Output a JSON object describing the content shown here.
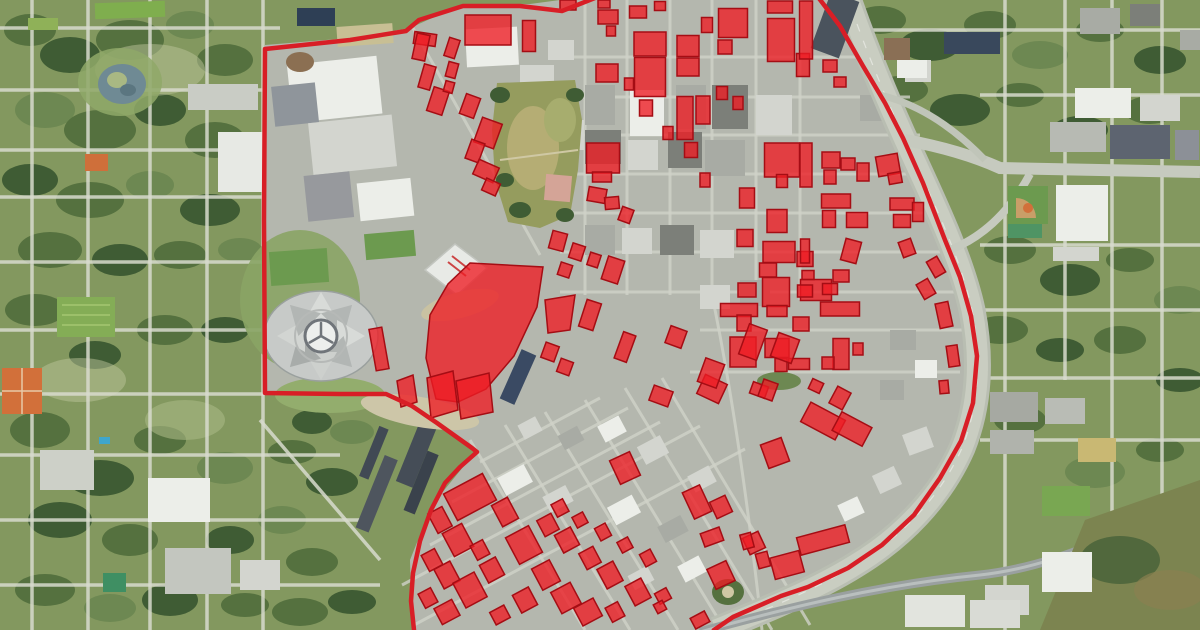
{
  "map": {
    "type": "aerial-satellite-with-overlay",
    "overlay": {
      "boundary_color": "#d81e26",
      "boundary_stroke_width": 4.5,
      "parcel_fill": "#ee1c24",
      "parcel_fill_opacity": 0.78,
      "parcel_stroke": "#a50d14",
      "parcel_stroke_width": 1.5,
      "boundary_points": [
        [
          600,
          -4
        ],
        [
          562,
          11
        ],
        [
          520,
          6
        ],
        [
          463,
          6
        ],
        [
          419,
          20
        ],
        [
          406,
          31
        ],
        [
          350,
          40
        ],
        [
          265,
          49
        ],
        [
          264,
          220
        ],
        [
          265,
          393
        ],
        [
          340,
          394
        ],
        [
          386,
          394
        ],
        [
          412,
          406
        ],
        [
          437,
          423
        ],
        [
          458,
          438
        ],
        [
          472,
          448
        ],
        [
          477,
          452
        ],
        [
          460,
          467
        ],
        [
          445,
          483
        ],
        [
          431,
          510
        ],
        [
          420,
          541
        ],
        [
          413,
          573
        ],
        [
          411,
          601
        ],
        [
          414,
          630
        ],
        [
          416,
          655
        ],
        [
          698,
          655
        ],
        [
          714,
          630
        ],
        [
          733,
          617
        ],
        [
          756,
          607
        ],
        [
          781,
          596
        ],
        [
          808,
          587
        ],
        [
          848,
          568
        ],
        [
          882,
          545
        ],
        [
          914,
          515
        ],
        [
          940,
          478
        ],
        [
          961,
          441
        ],
        [
          973,
          403
        ],
        [
          977,
          356
        ],
        [
          971,
          316
        ],
        [
          960,
          277
        ],
        [
          945,
          240
        ],
        [
          923,
          183
        ],
        [
          903,
          138
        ],
        [
          885,
          103
        ],
        [
          863,
          66
        ],
        [
          840,
          26
        ],
        [
          818,
          -3
        ],
        [
          790,
          -30
        ],
        [
          650,
          -30
        ]
      ],
      "parcel_rects": [
        [
          488,
          30,
          46,
          30,
          0
        ],
        [
          529,
          36,
          13,
          31,
          0
        ],
        [
          425,
          39,
          22,
          12,
          8
        ],
        [
          452,
          48,
          11,
          19,
          18
        ],
        [
          421,
          47,
          13,
          26,
          12
        ],
        [
          427,
          77,
          12,
          24,
          16
        ],
        [
          452,
          70,
          10,
          15,
          15
        ],
        [
          438,
          101,
          16,
          25,
          18
        ],
        [
          470,
          106,
          15,
          21,
          20
        ],
        [
          449,
          87,
          9,
          11,
          15
        ],
        [
          488,
          133,
          21,
          26,
          20
        ],
        [
          475,
          151,
          14,
          20,
          20
        ],
        [
          486,
          171,
          22,
          16,
          24
        ],
        [
          491,
          187,
          15,
          13,
          24
        ],
        [
          568,
          5,
          16,
          10,
          0
        ],
        [
          604,
          4,
          12,
          8,
          0
        ],
        [
          608,
          17,
          20,
          14,
          0
        ],
        [
          611,
          31,
          9,
          10,
          0
        ],
        [
          638,
          12,
          17,
          12,
          0
        ],
        [
          660,
          6,
          11,
          9,
          0
        ],
        [
          607,
          73,
          22,
          18,
          0
        ],
        [
          650,
          44,
          32,
          24,
          0
        ],
        [
          650,
          77,
          31,
          39,
          0
        ],
        [
          688,
          46,
          22,
          21,
          0
        ],
        [
          688,
          67,
          22,
          18,
          0
        ],
        [
          707,
          25,
          11,
          15,
          0
        ],
        [
          733,
          23,
          29,
          29,
          0
        ],
        [
          780,
          7,
          25,
          12,
          0
        ],
        [
          725,
          47,
          14,
          14,
          0
        ],
        [
          781,
          40,
          27,
          43,
          0
        ],
        [
          803,
          65,
          13,
          23,
          0
        ],
        [
          629,
          84,
          9,
          12,
          0
        ],
        [
          646,
          108,
          13,
          16,
          0
        ],
        [
          668,
          133,
          10,
          13,
          0
        ],
        [
          722,
          93,
          11,
          13,
          0
        ],
        [
          738,
          103,
          10,
          13,
          0
        ],
        [
          685,
          118,
          16,
          43,
          0
        ],
        [
          703,
          110,
          14,
          28,
          0
        ],
        [
          603,
          158,
          33,
          30,
          0
        ],
        [
          602,
          177,
          19,
          10,
          0
        ],
        [
          691,
          150,
          13,
          15,
          0
        ],
        [
          705,
          180,
          10,
          14,
          0
        ],
        [
          597,
          195,
          18,
          14,
          10
        ],
        [
          612,
          203,
          14,
          12,
          -5
        ],
        [
          626,
          215,
          12,
          14,
          20
        ],
        [
          782,
          160,
          35,
          34,
          0
        ],
        [
          782,
          181,
          11,
          13,
          0
        ],
        [
          747,
          198,
          15,
          20,
          0
        ],
        [
          777,
          221,
          20,
          23,
          0
        ],
        [
          745,
          238,
          16,
          17,
          0
        ],
        [
          779,
          252,
          32,
          21,
          0
        ],
        [
          768,
          270,
          17,
          14,
          0
        ],
        [
          805,
          259,
          16,
          15,
          0
        ],
        [
          830,
          66,
          14,
          12,
          0
        ],
        [
          840,
          82,
          12,
          10,
          0
        ],
        [
          806,
          30,
          13,
          58,
          0
        ],
        [
          806,
          165,
          12,
          44,
          0
        ],
        [
          831,
          160,
          18,
          16,
          0
        ],
        [
          848,
          164,
          14,
          12,
          0
        ],
        [
          863,
          172,
          12,
          18,
          0
        ],
        [
          830,
          177,
          12,
          14,
          0
        ],
        [
          888,
          165,
          22,
          20,
          -10
        ],
        [
          895,
          178,
          13,
          11,
          -10
        ],
        [
          836,
          201,
          29,
          14,
          0
        ],
        [
          829,
          219,
          13,
          17,
          0
        ],
        [
          857,
          220,
          21,
          15,
          0
        ],
        [
          902,
          204,
          24,
          12,
          0
        ],
        [
          902,
          221,
          17,
          13,
          0
        ],
        [
          918,
          212,
          11,
          19,
          0
        ],
        [
          851,
          251,
          16,
          22,
          15
        ],
        [
          805,
          251,
          9,
          24,
          0
        ],
        [
          816,
          290,
          31,
          21,
          0
        ],
        [
          907,
          248,
          13,
          16,
          -20
        ],
        [
          936,
          267,
          12,
          18,
          -30
        ],
        [
          926,
          289,
          13,
          17,
          -30
        ],
        [
          944,
          315,
          13,
          25,
          -12
        ],
        [
          953,
          356,
          11,
          21,
          -8
        ],
        [
          944,
          387,
          9,
          13,
          -5
        ],
        [
          747,
          290,
          18,
          14,
          0
        ],
        [
          776,
          292,
          27,
          29,
          0
        ],
        [
          805,
          291,
          15,
          12,
          0
        ],
        [
          808,
          275,
          12,
          9,
          0
        ],
        [
          841,
          276,
          16,
          12,
          0
        ],
        [
          830,
          289,
          15,
          11,
          0
        ],
        [
          739,
          310,
          37,
          13,
          0
        ],
        [
          744,
          323,
          14,
          16,
          0
        ],
        [
          777,
          311,
          20,
          11,
          0
        ],
        [
          840,
          309,
          39,
          14,
          0
        ],
        [
          801,
          324,
          16,
          14,
          0
        ],
        [
          743,
          352,
          26,
          30,
          0
        ],
        [
          777,
          348,
          24,
          19,
          0
        ],
        [
          781,
          365,
          12,
          13,
          0
        ],
        [
          799,
          364,
          21,
          11,
          0
        ],
        [
          841,
          354,
          16,
          31,
          0
        ],
        [
          828,
          363,
          12,
          12,
          0
        ],
        [
          858,
          349,
          10,
          12,
          0
        ],
        [
          712,
          389,
          24,
          21,
          25
        ],
        [
          816,
          386,
          12,
          11,
          25
        ],
        [
          840,
          398,
          15,
          19,
          28
        ],
        [
          823,
          421,
          39,
          22,
          28
        ],
        [
          852,
          429,
          34,
          21,
          28
        ],
        [
          759,
          390,
          16,
          12,
          20
        ],
        [
          558,
          241,
          15,
          18,
          15
        ],
        [
          577,
          252,
          13,
          15,
          18
        ],
        [
          594,
          260,
          11,
          13,
          18
        ],
        [
          565,
          270,
          12,
          13,
          18
        ],
        [
          613,
          270,
          17,
          24,
          18
        ],
        [
          590,
          315,
          15,
          28,
          18
        ],
        [
          625,
          347,
          13,
          28,
          20
        ],
        [
          676,
          337,
          17,
          18,
          20
        ],
        [
          550,
          352,
          14,
          16,
          20
        ],
        [
          565,
          367,
          13,
          14,
          20
        ],
        [
          661,
          396,
          20,
          16,
          20
        ],
        [
          711,
          373,
          20,
          25,
          20
        ],
        [
          753,
          342,
          19,
          32,
          20
        ],
        [
          768,
          390,
          15,
          18,
          20
        ],
        [
          785,
          348,
          22,
          25,
          20
        ],
        [
          625,
          468,
          22,
          26,
          -25
        ],
        [
          697,
          502,
          19,
          29,
          -25
        ],
        [
          721,
          507,
          17,
          18,
          -25
        ],
        [
          754,
          543,
          17,
          18,
          -25
        ],
        [
          721,
          575,
          21,
          22,
          -25
        ],
        [
          775,
          453,
          22,
          25,
          -20
        ],
        [
          379,
          349,
          13,
          42,
          -10
        ],
        [
          470,
          497,
          44,
          30,
          -28
        ],
        [
          440,
          520,
          16,
          22,
          -28
        ],
        [
          458,
          540,
          22,
          26,
          -28
        ],
        [
          432,
          560,
          15,
          18,
          -28
        ],
        [
          447,
          575,
          18,
          22,
          -28
        ],
        [
          428,
          598,
          14,
          16,
          -28
        ],
        [
          447,
          612,
          20,
          18,
          -28
        ],
        [
          470,
          590,
          24,
          28,
          -28
        ],
        [
          492,
          570,
          18,
          20,
          -28
        ],
        [
          480,
          550,
          14,
          16,
          -28
        ],
        [
          505,
          512,
          18,
          24,
          -28
        ],
        [
          524,
          545,
          26,
          30,
          -28
        ],
        [
          546,
          575,
          20,
          24,
          -28
        ],
        [
          566,
          598,
          22,
          24,
          -28
        ],
        [
          525,
          600,
          18,
          20,
          -28
        ],
        [
          500,
          615,
          16,
          14,
          -28
        ],
        [
          548,
          525,
          16,
          18,
          -28
        ],
        [
          567,
          540,
          18,
          20,
          -28
        ],
        [
          590,
          558,
          16,
          18,
          -28
        ],
        [
          610,
          575,
          18,
          22,
          -28
        ],
        [
          588,
          612,
          22,
          20,
          -28
        ],
        [
          615,
          612,
          14,
          16,
          -28
        ],
        [
          638,
          592,
          18,
          22,
          -28
        ],
        [
          663,
          596,
          13,
          12,
          -28
        ],
        [
          700,
          620,
          16,
          12,
          -28
        ],
        [
          560,
          508,
          13,
          14,
          -28
        ],
        [
          580,
          520,
          12,
          12,
          -28
        ],
        [
          603,
          532,
          12,
          14,
          -28
        ],
        [
          625,
          545,
          12,
          12,
          -28
        ],
        [
          648,
          558,
          12,
          14,
          -28
        ],
        [
          660,
          607,
          10,
          10,
          -28
        ],
        [
          712,
          537,
          20,
          14,
          -20
        ],
        [
          747,
          541,
          11,
          15,
          -15
        ],
        [
          763,
          560,
          12,
          15,
          -15
        ],
        [
          787,
          565,
          30,
          22,
          -15
        ],
        [
          823,
          540,
          50,
          18,
          -15
        ]
      ],
      "parcel_polygons": [
        [
          [
            470,
            263
          ],
          [
            543,
            267
          ],
          [
            537,
            307
          ],
          [
            514,
            356
          ],
          [
            486,
            389
          ],
          [
            458,
            402
          ],
          [
            436,
            399
          ],
          [
            426,
            358
          ],
          [
            430,
            315
          ],
          [
            448,
            284
          ]
        ],
        [
          [
            397,
            381
          ],
          [
            413,
            375
          ],
          [
            417,
            402
          ],
          [
            401,
            407
          ]
        ],
        [
          [
            427,
            378
          ],
          [
            453,
            371
          ],
          [
            458,
            410
          ],
          [
            431,
            418
          ]
        ],
        [
          [
            456,
            381
          ],
          [
            489,
            373
          ],
          [
            493,
            412
          ],
          [
            461,
            419
          ]
        ],
        [
          [
            545,
            300
          ],
          [
            575,
            295
          ],
          [
            570,
            330
          ],
          [
            548,
            333
          ]
        ]
      ]
    }
  }
}
